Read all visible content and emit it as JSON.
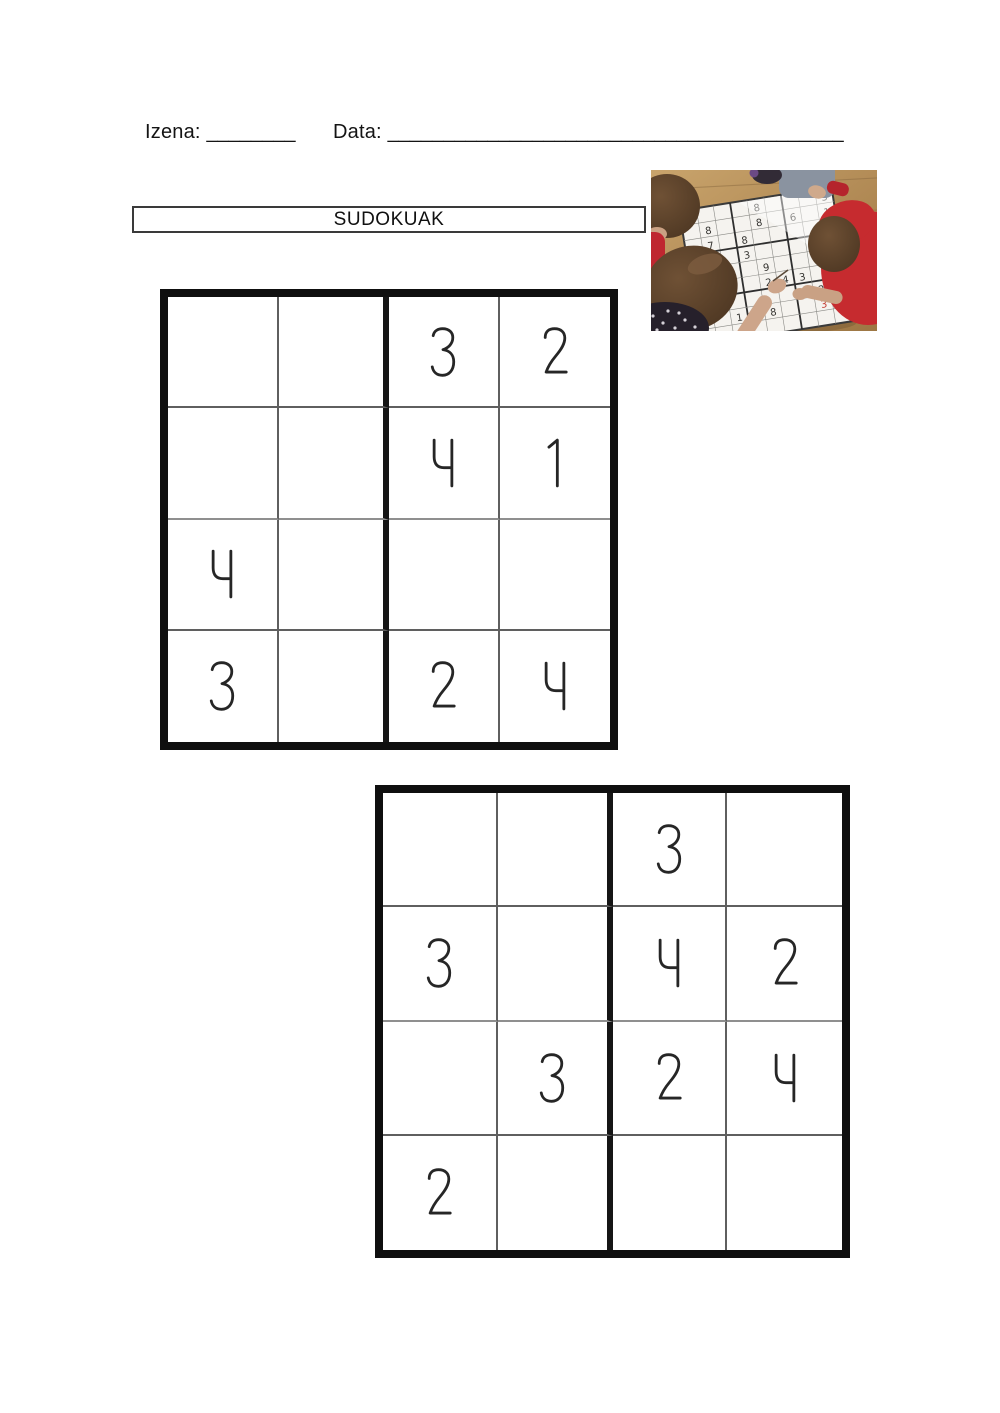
{
  "header": {
    "name_label": "Izena:",
    "name_blank": "________",
    "date_label": "Data:",
    "date_blank": "_________________________________________"
  },
  "title": {
    "text": "SUDOKUAK"
  },
  "photo": {
    "description": "children-solving-giant-sudoku-on-table",
    "colors": {
      "table_wood": "#b18a55",
      "red_shirt": "#c62b2f",
      "board_white": "#f5f3ef",
      "red_number": "#c3392f"
    },
    "board_numbers": [
      {
        "r": 0,
        "c": 4,
        "n": "8"
      },
      {
        "r": 0,
        "c": 8,
        "n": "3"
      },
      {
        "r": 1,
        "c": 1,
        "n": "8"
      },
      {
        "r": 1,
        "c": 4,
        "n": "8"
      },
      {
        "r": 1,
        "c": 6,
        "n": "6"
      },
      {
        "r": 1,
        "c": 8,
        "n": "1"
      },
      {
        "r": 2,
        "c": 1,
        "n": "7"
      },
      {
        "r": 2,
        "c": 3,
        "n": "8"
      },
      {
        "r": 3,
        "c": 1,
        "n": "7"
      },
      {
        "r": 3,
        "c": 3,
        "n": "3"
      },
      {
        "r": 3,
        "c": 7,
        "n": "4"
      },
      {
        "r": 4,
        "c": 4,
        "n": "9"
      },
      {
        "r": 4,
        "c": 8,
        "n": "2"
      },
      {
        "r": 5,
        "c": 0,
        "n": "5"
      },
      {
        "r": 5,
        "c": 4,
        "n": "2"
      },
      {
        "r": 5,
        "c": 5,
        "n": "4"
      },
      {
        "r": 5,
        "c": 6,
        "n": "3"
      },
      {
        "r": 6,
        "c": 7,
        "n": "2"
      },
      {
        "r": 6,
        "c": 8,
        "n": "6"
      },
      {
        "r": 7,
        "c": 2,
        "n": "1"
      },
      {
        "r": 7,
        "c": 3,
        "n": "5"
      },
      {
        "r": 7,
        "c": 4,
        "n": "8"
      },
      {
        "r": 7,
        "c": 7,
        "n": "3",
        "red": true
      },
      {
        "r": 8,
        "c": 1,
        "n": "8"
      },
      {
        "r": 8,
        "c": 2,
        "n": "9"
      }
    ]
  },
  "grids": [
    {
      "name": "sudoku-grid-1",
      "rows": 4,
      "cols": 4,
      "cells": [
        [
          "",
          "",
          "3",
          "2"
        ],
        [
          "",
          "",
          "4",
          "1"
        ],
        [
          "4",
          "",
          "",
          ""
        ],
        [
          "3",
          "",
          "2",
          "4"
        ]
      ]
    },
    {
      "name": "sudoku-grid-2",
      "rows": 4,
      "cols": 4,
      "cells": [
        [
          "",
          "",
          "3",
          ""
        ],
        [
          "3",
          "",
          "4",
          "2"
        ],
        [
          "",
          "3",
          "2",
          "4"
        ],
        [
          "2",
          "",
          "",
          ""
        ]
      ]
    }
  ]
}
